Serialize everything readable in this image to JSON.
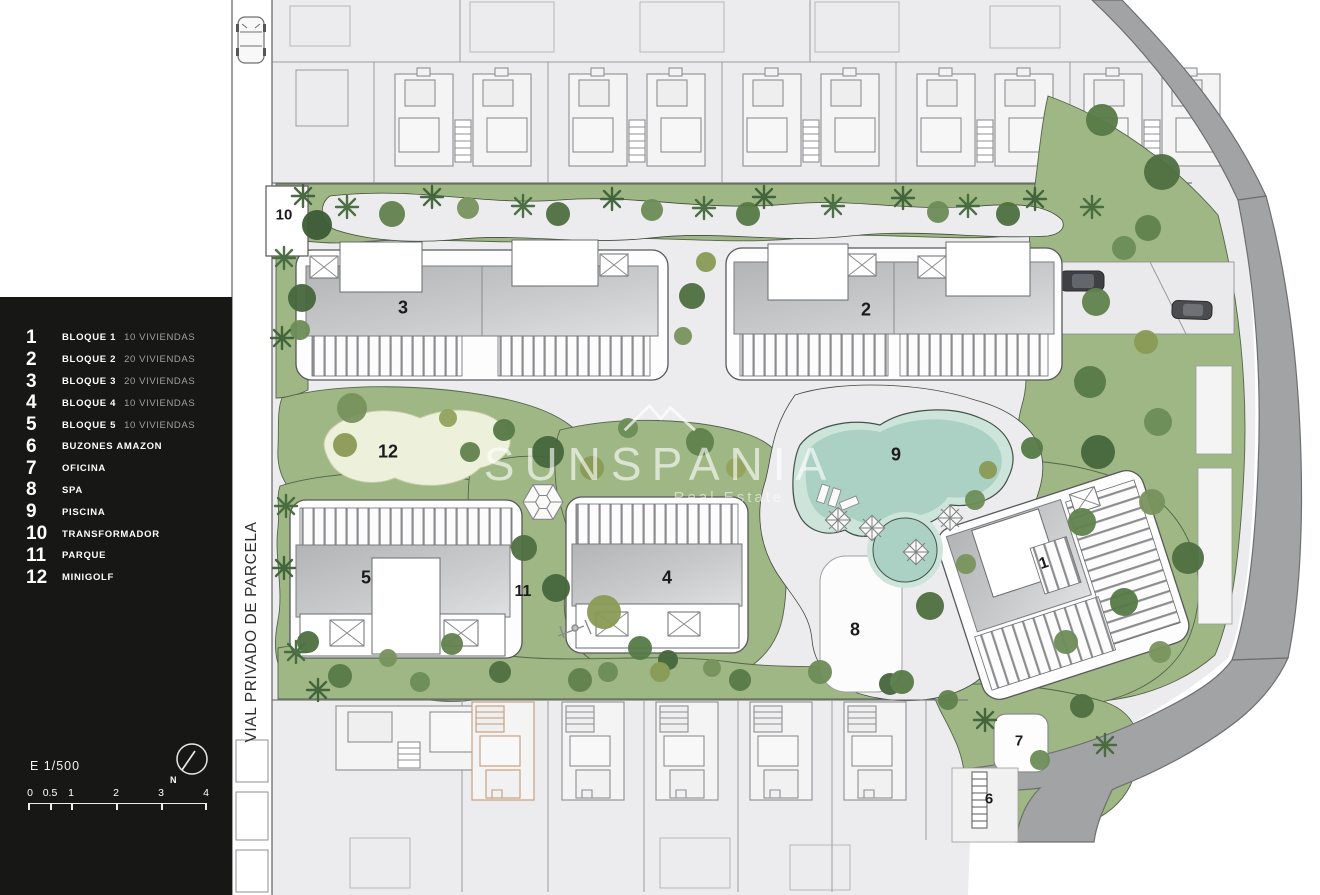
{
  "colors": {
    "panel_bg": "#171715",
    "ground": "#ececee",
    "road": "#a2a3a5",
    "grass": "#9eb785",
    "pool": "#abd0c4",
    "pool_rim": "#cde4da",
    "minigolf": "#edf0db",
    "orange_villa_outline": "#c49a78",
    "label_text": "#1b1b1d"
  },
  "legend": {
    "items": [
      {
        "num": "1",
        "label": "BLOQUE 1",
        "detail": "10 VIVIENDAS"
      },
      {
        "num": "2",
        "label": "BLOQUE 2",
        "detail": "20 VIVIENDAS"
      },
      {
        "num": "3",
        "label": "BLOQUE 3",
        "detail": "20 VIVIENDAS"
      },
      {
        "num": "4",
        "label": "BLOQUE 4",
        "detail": "10 VIVIENDAS"
      },
      {
        "num": "5",
        "label": "BLOQUE 5",
        "detail": "10 VIVIENDAS"
      },
      {
        "num": "6",
        "label": "BUZONES AMAZON",
        "detail": ""
      },
      {
        "num": "7",
        "label": "OFICINA",
        "detail": ""
      },
      {
        "num": "8",
        "label": "SPA",
        "detail": ""
      },
      {
        "num": "9",
        "label": "PISCINA",
        "detail": ""
      },
      {
        "num": "10",
        "label": "TRANSFORMADOR",
        "detail": ""
      },
      {
        "num": "11",
        "label": "PARQUE",
        "detail": ""
      },
      {
        "num": "12",
        "label": "MINIGOLF",
        "detail": ""
      }
    ],
    "scale_text": "E 1/500",
    "compass_label": "N",
    "scale_ticks": [
      "0",
      "0.5",
      "1",
      "2",
      "3",
      "4"
    ]
  },
  "map": {
    "road_label": "VIAL PRIVADO DE PARCELA",
    "watermark_title": "SUNSPANIA",
    "watermark_subtitle": "Real Estate",
    "markers": {
      "b1": "1",
      "b2": "2",
      "b3": "3",
      "b4": "4",
      "b5": "5",
      "m6": "6",
      "m7": "7",
      "m8": "8",
      "m9": "9",
      "m10": "10",
      "m11": "11",
      "m12": "12"
    }
  }
}
